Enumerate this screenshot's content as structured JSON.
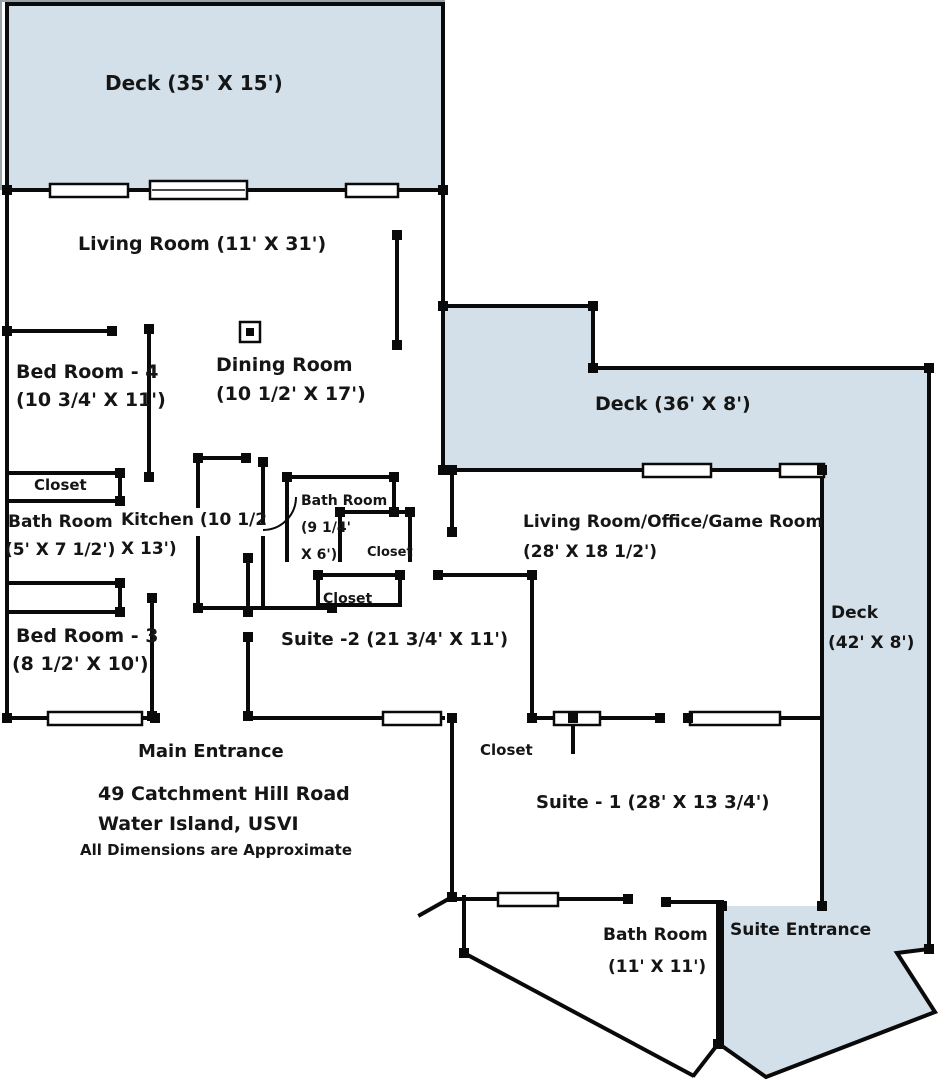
{
  "title": "Floor Plan - 49 Catchment Hill Road, Water Island, USVI",
  "colors": {
    "deck": "#d3e0ea",
    "wall": "#0a0a0a",
    "text": "#151515",
    "background": "#ffffff"
  },
  "rooms": {
    "deck_top": {
      "label": "Deck (35' X 15')"
    },
    "living_room": {
      "label": "Living Room (11' X 31')"
    },
    "bed_room_4": {
      "name": "Bed Room - 4",
      "dims": "(10 3/4' X 11')"
    },
    "dining_room": {
      "name": "Dining Room",
      "dims": "(10 1/2' X 17')"
    },
    "deck_upper_right": {
      "label": "Deck (36' X 8')"
    },
    "closet_bed4": {
      "label": "Closet"
    },
    "bath_room_small": {
      "name": "Bath Room",
      "dims": "(5' X 7 1/2')"
    },
    "kitchen": {
      "name": "Kitchen (10 1/2",
      "dims": "X 13')"
    },
    "bath_room_mid": {
      "name": "Bath Room",
      "dims_line1": "(9 1/4'",
      "dims_line2": "X 6')"
    },
    "closet_mid_upper": {
      "label": "Closet"
    },
    "closet_mid_lower": {
      "label": "Closet"
    },
    "living_office_game": {
      "name": "Living Room/Office/Game Room",
      "dims": "(28' X 18 1/2')"
    },
    "deck_right_side": {
      "name": "Deck",
      "dims": "(42' X 8')"
    },
    "bed_room_3": {
      "name": "Bed Room - 3",
      "dims": "(8 1/2' X 10')"
    },
    "suite_2": {
      "label": "Suite -2 (21 3/4' X 11')"
    },
    "main_entrance": {
      "label": "Main Entrance"
    },
    "closet_suite1": {
      "label": "Closet"
    },
    "suite_1": {
      "label": "Suite - 1 (28' X 13 3/4')"
    },
    "bath_room_suite1": {
      "name": "Bath Room",
      "dims": "(11' X 11')"
    },
    "suite_entrance": {
      "label": "Suite Entrance"
    }
  },
  "footer": {
    "address_line1": "49 Catchment Hill Road",
    "address_line2": "Water Island, USVI",
    "disclaimer": "All Dimensions are Approximate"
  }
}
